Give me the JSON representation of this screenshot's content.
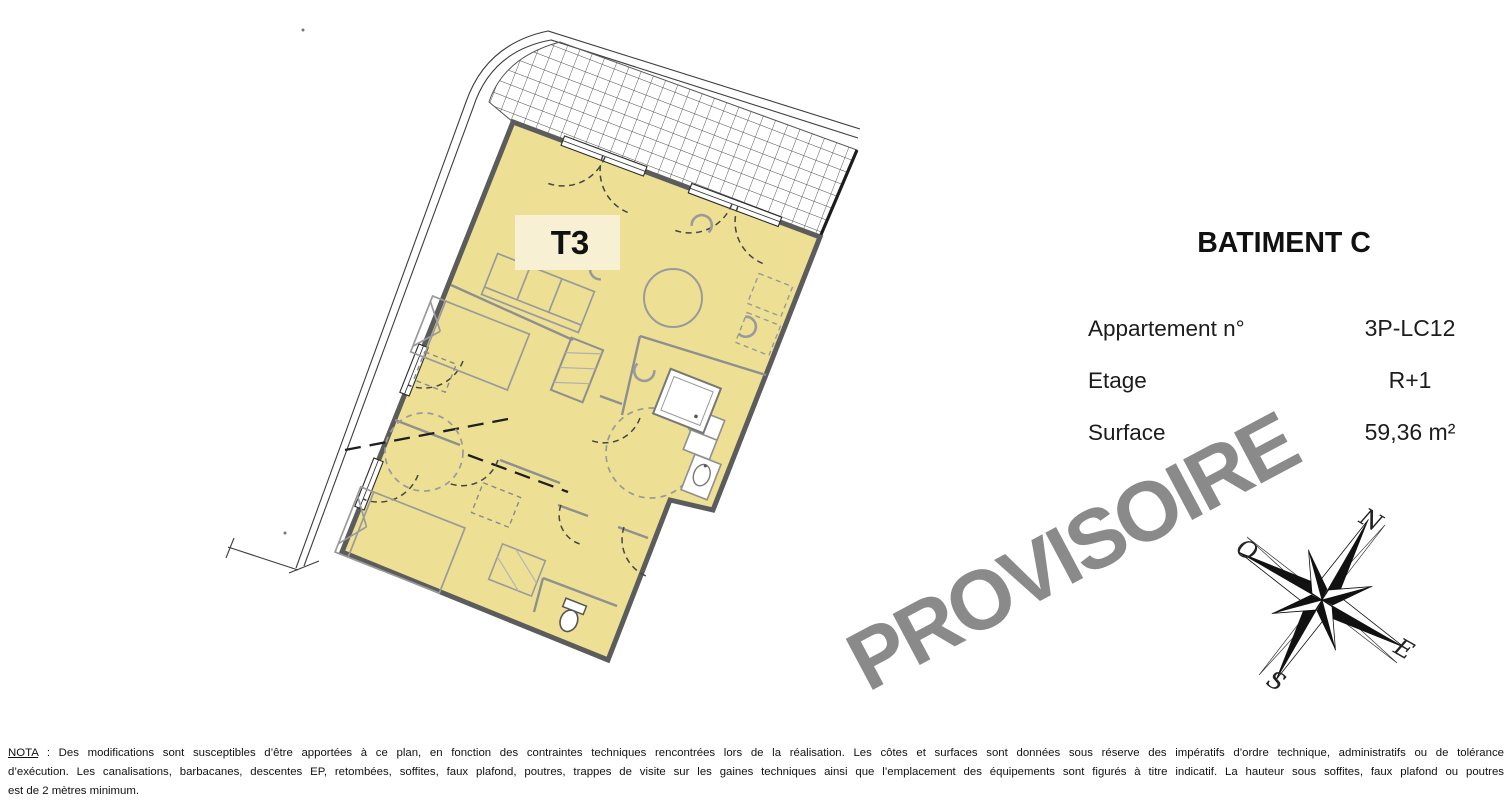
{
  "plan": {
    "unit_label": "T3",
    "floor_fill": "#ede095",
    "label_box_fill": "#f7f0d2"
  },
  "info_panel": {
    "title": "BATIMENT C",
    "rows": [
      {
        "label": "Appartement n°",
        "value": "3P-LC12"
      },
      {
        "label": "Etage",
        "value": "R+1"
      },
      {
        "label": "Surface",
        "value": "59,36 m²"
      }
    ]
  },
  "watermark": {
    "text": "PROVISOIRE",
    "color": "#8a8a8a"
  },
  "compass": {
    "north": "N",
    "west": "O",
    "east": "E",
    "south": "S"
  },
  "nota": {
    "label": "NOTA",
    "line1": " : Des modifications sont susceptibles d’être apportées à ce plan, en fonction des contraintes techniques rencontrées lors de la réalisation. Les côtes et surfaces sont données sous réserve des impératifs d’ordre technique, administratifs ou de tolérance",
    "line2": "d’exécution. Les canalisations, barbacanes, descentes EP, retombées, soffites, faux plafond, poutres, trappes de visite sur les gaines techniques ainsi que l’emplacement des équipements sont figurés à titre indicatif. La hauteur sous soffites, faux plafond ou poutres",
    "line3": "est de 2 mètres minimum."
  }
}
